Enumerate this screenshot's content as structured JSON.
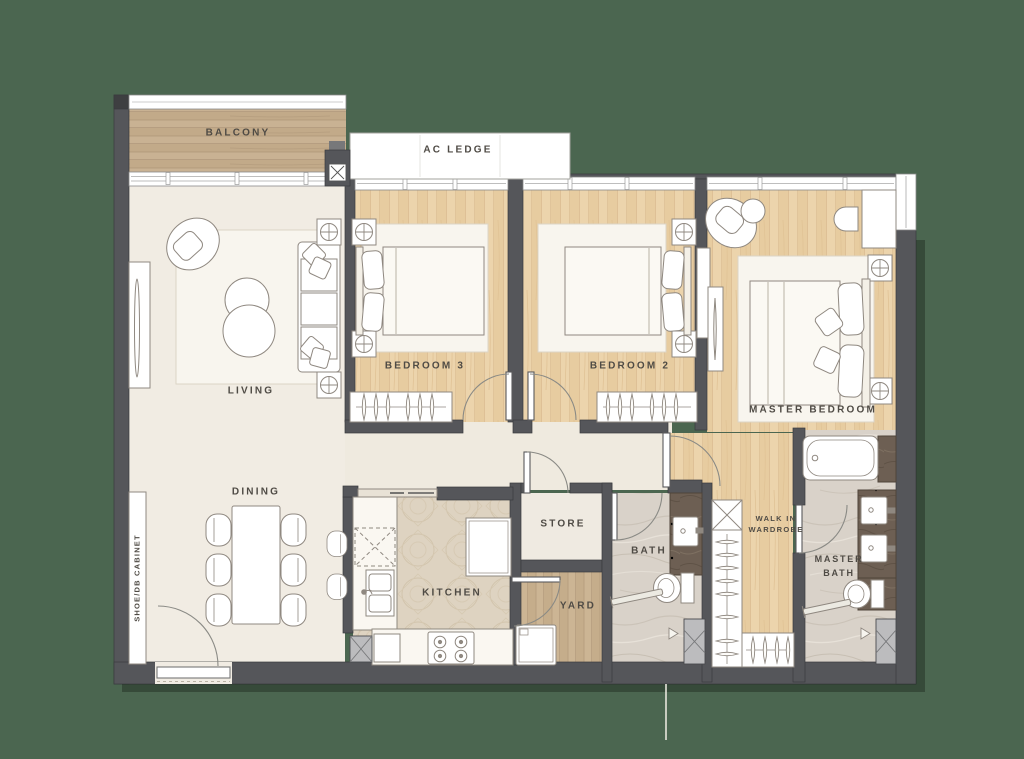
{
  "title": "Apartment floor plan",
  "labels": {
    "balcony": "BALCONY",
    "ac_ledge": "AC LEDGE",
    "bedroom3": "BEDROOM 3",
    "bedroom2": "BEDROOM 2",
    "master_bedroom": "MASTER BEDROOM",
    "living": "LIVING",
    "dining": "DINING",
    "shoe_cabinet": "SHOE/DB CABINET",
    "kitchen": "KITCHEN",
    "store": "STORE",
    "yard": "YARD",
    "bath": "BATH",
    "walk_in_line1": "WALK IN",
    "walk_in_line2": "WARDROBE",
    "master_bath_line1": "MASTER",
    "master_bath_line2": "BATH"
  },
  "colors": {
    "background_green": "#4b6650",
    "wall_gray": "#55565a",
    "wood_bedroom": "#ecd4ac",
    "wood_balcony": "#c9b293",
    "wood_yard": "#ccb594",
    "floor_cream": "#f1ece3",
    "kitchen_tile": "#ded3c1",
    "marble_light": "#d9d2c9",
    "counter_brown": "#6d5f53",
    "label_text": "#4f4b45"
  }
}
